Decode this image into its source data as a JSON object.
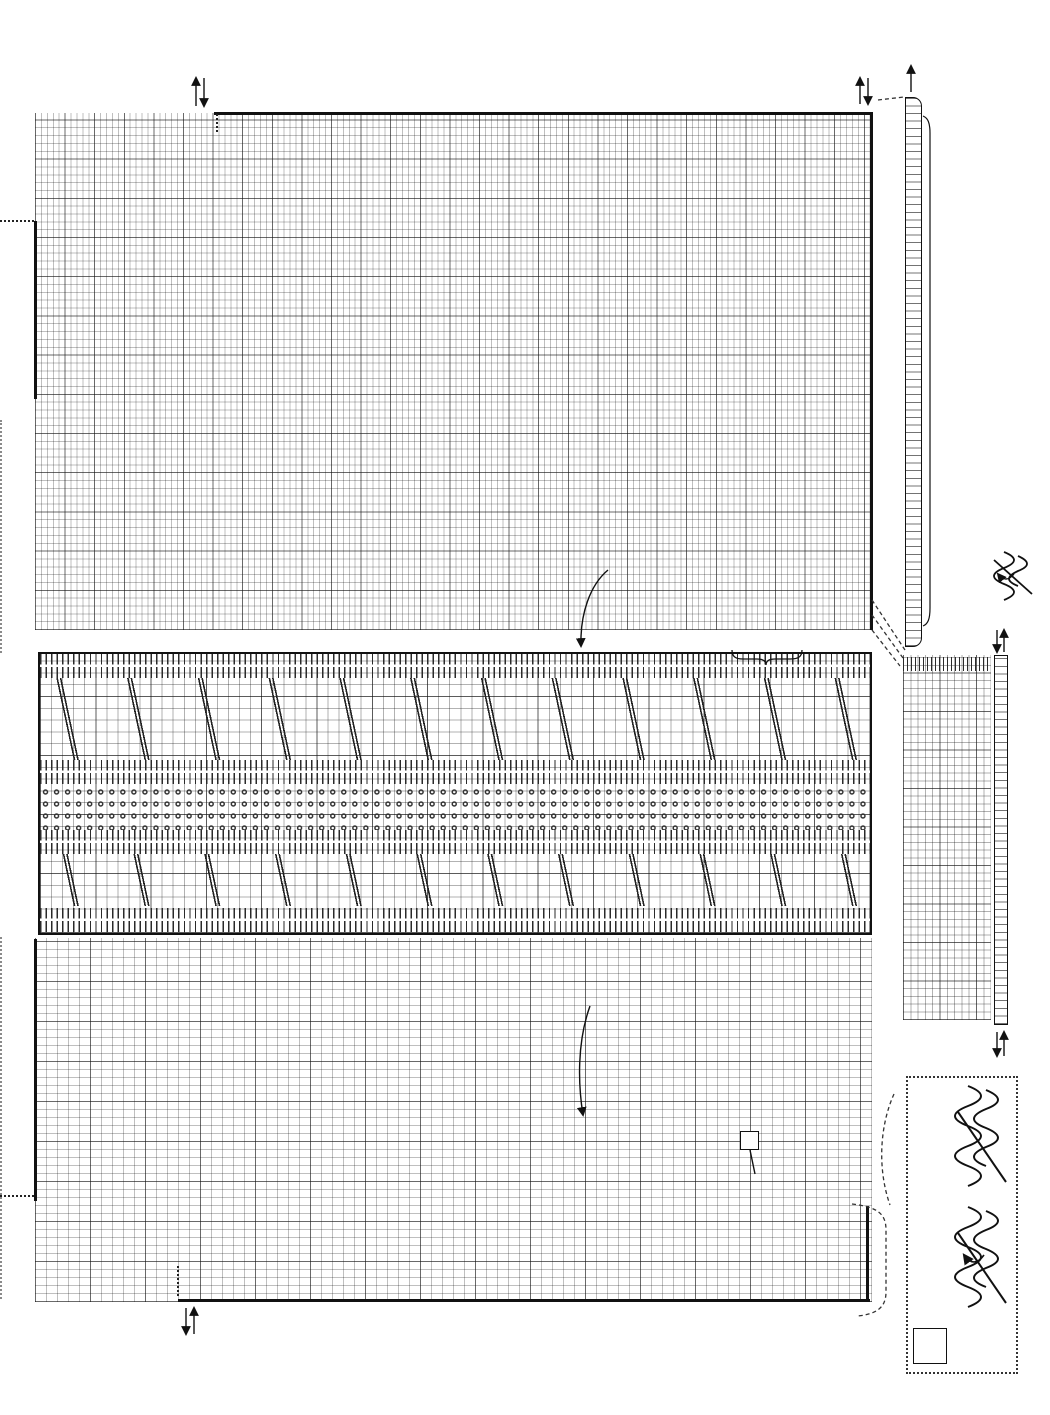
{
  "page": {
    "number": "71"
  },
  "symbols": {
    "lace_motif": "o+o",
    "decrease": "λ",
    "twisted_increase": "Ω",
    "heart_filled": "♥",
    "heart_open": "♡"
  },
  "chart_top": {
    "stitch_numbers": [
      {
        "t": "112",
        "x": 216,
        "y": 86
      },
      {
        "t": "110",
        "x": 228,
        "y": 86
      },
      {
        "t": "105",
        "x": 258,
        "y": 86
      },
      {
        "t": "100",
        "x": 287,
        "y": 86
      },
      {
        "t": "95",
        "x": 318,
        "y": 93
      },
      {
        "t": "90",
        "x": 347,
        "y": 93
      },
      {
        "t": "85",
        "x": 377,
        "y": 93
      },
      {
        "t": "80",
        "x": 406,
        "y": 93
      },
      {
        "t": "75",
        "x": 436,
        "y": 93
      },
      {
        "t": "70",
        "x": 465,
        "y": 93
      },
      {
        "t": "65",
        "x": 495,
        "y": 93
      },
      {
        "t": "60",
        "x": 524,
        "y": 93
      },
      {
        "t": "55",
        "x": 554,
        "y": 93
      },
      {
        "t": "50",
        "x": 583,
        "y": 93
      },
      {
        "t": "45",
        "x": 613,
        "y": 93
      },
      {
        "t": "40",
        "x": 642,
        "y": 93
      },
      {
        "t": "35",
        "x": 672,
        "y": 93
      },
      {
        "t": "30",
        "x": 701,
        "y": 93
      },
      {
        "t": "25",
        "x": 731,
        "y": 93
      },
      {
        "t": "20",
        "x": 760,
        "y": 93
      },
      {
        "t": "15",
        "x": 790,
        "y": 93
      },
      {
        "t": "10",
        "x": 819,
        "y": 93
      },
      {
        "t": "5",
        "x": 851,
        "y": 99
      }
    ],
    "shaping_numbers": [
      {
        "t": "30",
        "x": 42,
        "y": 194
      },
      {
        "t": "25",
        "x": 71,
        "y": 192
      },
      {
        "t": "20",
        "x": 100,
        "y": 188
      },
      {
        "t": "15",
        "x": 129,
        "y": 181
      },
      {
        "t": "10",
        "x": 158,
        "y": 169
      },
      {
        "t": "5",
        "x": 189,
        "y": 144
      }
    ],
    "row_numbers": [
      {
        "t": "1",
        "x": 876,
        "y": 112
      },
      {
        "t": "5",
        "x": 876,
        "y": 144
      },
      {
        "t": "10",
        "x": 876,
        "y": 181
      },
      {
        "t": "15",
        "x": 876,
        "y": 220
      },
      {
        "t": "20",
        "x": 876,
        "y": 260
      },
      {
        "t": "25",
        "x": 876,
        "y": 299
      },
      {
        "t": "30",
        "x": 876,
        "y": 338
      },
      {
        "t": "35",
        "x": 876,
        "y": 377
      },
      {
        "t": "40",
        "x": 876,
        "y": 417
      },
      {
        "t": "45",
        "x": 876,
        "y": 456
      },
      {
        "t": "50",
        "x": 876,
        "y": 495
      },
      {
        "t": "55",
        "x": 876,
        "y": 534
      },
      {
        "t": "60",
        "x": 876,
        "y": 573
      },
      {
        "t": "65",
        "x": 876,
        "y": 608
      }
    ],
    "direction_labels": [
      {
        "t": "1",
        "x": 206,
        "y": 70
      },
      {
        "t": "1",
        "x": 862,
        "y": 68
      }
    ],
    "motifs": [
      [
        80,
        42
      ],
      [
        222,
        42
      ],
      [
        364,
        42
      ],
      [
        506,
        42
      ],
      [
        648,
        42
      ],
      [
        790,
        42
      ],
      [
        151,
        89
      ],
      [
        293,
        89
      ],
      [
        435,
        89
      ],
      [
        577,
        89
      ],
      [
        719,
        89
      ],
      [
        80,
        136
      ],
      [
        222,
        136
      ],
      [
        364,
        136
      ],
      [
        506,
        136
      ],
      [
        648,
        136
      ],
      [
        790,
        136
      ],
      [
        151,
        183
      ],
      [
        293,
        183
      ],
      [
        435,
        183
      ],
      [
        577,
        183
      ],
      [
        719,
        183
      ],
      [
        80,
        230
      ],
      [
        222,
        230
      ],
      [
        364,
        230
      ],
      [
        506,
        230
      ],
      [
        648,
        230
      ],
      [
        790,
        230
      ],
      [
        151,
        277
      ],
      [
        293,
        277
      ],
      [
        435,
        277
      ],
      [
        577,
        277
      ],
      [
        719,
        277
      ],
      [
        80,
        324
      ],
      [
        222,
        324
      ],
      [
        364,
        324
      ],
      [
        506,
        324
      ],
      [
        648,
        324
      ],
      [
        790,
        324
      ],
      [
        151,
        371
      ],
      [
        293,
        371
      ],
      [
        435,
        371
      ],
      [
        577,
        371
      ],
      [
        719,
        371
      ],
      [
        80,
        418
      ],
      [
        222,
        418
      ],
      [
        364,
        418
      ],
      [
        506,
        418
      ],
      [
        648,
        418
      ],
      [
        790,
        418
      ],
      [
        151,
        465
      ],
      [
        293,
        465
      ],
      [
        435,
        465
      ],
      [
        577,
        465
      ],
      [
        719,
        465
      ]
    ],
    "edge_decreases": [
      [
        6,
        97
      ],
      [
        21,
        88
      ],
      [
        36,
        79
      ],
      [
        51,
        70
      ],
      [
        67,
        61
      ],
      [
        82,
        52
      ],
      [
        97,
        44
      ],
      [
        112,
        35
      ],
      [
        128,
        26
      ],
      [
        143,
        17
      ],
      [
        158,
        9
      ],
      [
        173,
        3
      ],
      [
        6,
        272
      ],
      [
        54,
        285
      ],
      [
        102,
        298
      ],
      [
        150,
        311
      ],
      [
        197,
        325
      ],
      [
        245,
        338
      ],
      [
        293,
        351
      ],
      [
        341,
        364
      ],
      [
        389,
        377
      ],
      [
        436,
        391
      ],
      [
        484,
        404
      ],
      [
        532,
        417
      ],
      [
        580,
        430
      ],
      [
        628,
        443
      ],
      [
        675,
        457
      ],
      [
        723,
        470
      ],
      [
        771,
        483
      ],
      [
        815,
        495
      ]
    ]
  },
  "pickup_strip": {
    "count_label": "18",
    "count_pos": [
      {
        "t": "18",
        "x": 899,
        "y": 46
      }
    ],
    "annotation": "別糸鎖から72目拾う"
  },
  "legend": {
    "line1": "＝18段めで♡の2目を編む時に",
    "line2": "♥の2目を裏側に折り返し一緒に編む",
    "front_label": "おもて"
  },
  "middle_chart": {
    "repeat_label": "12段1模様",
    "continue_label": "続けて編む"
  },
  "gusset": {
    "top_numbers": [
      {
        "t": "15",
        "x": 916,
        "y": 636
      },
      {
        "t": "10",
        "x": 944,
        "y": 636
      },
      {
        "t": "5",
        "x": 974,
        "y": 641
      }
    ],
    "row_numbers": [
      {
        "t": "1",
        "x": 1011,
        "y": 655
      },
      {
        "t": "5",
        "x": 1011,
        "y": 685
      },
      {
        "t": "10",
        "x": 1011,
        "y": 722
      },
      {
        "t": "15",
        "x": 1011,
        "y": 761
      },
      {
        "t": "20",
        "x": 1011,
        "y": 799
      },
      {
        "t": "25",
        "x": 1011,
        "y": 838
      },
      {
        "t": "30",
        "x": 1011,
        "y": 876
      },
      {
        "t": "35",
        "x": 1011,
        "y": 915
      },
      {
        "t": "40",
        "x": 1011,
        "y": 953
      },
      {
        "t": "45",
        "x": 1011,
        "y": 992
      },
      {
        "t": "48",
        "x": 1011,
        "y": 1013
      }
    ],
    "direction_labels": [
      {
        "t": "1",
        "x": 1008,
        "y": 636
      },
      {
        "t": "1",
        "x": 998,
        "y": 1060
      }
    ],
    "bottom_count": [
      {
        "t": "4",
        "x": 901,
        "y": 1026
      }
    ],
    "hearts": {
      "filled": "♥",
      "open": "♡"
    },
    "edge_decreases": [
      [
        2,
        48
      ],
      [
        8,
        93
      ],
      [
        15,
        138
      ],
      [
        22,
        183
      ],
      [
        29,
        228
      ],
      [
        36,
        273
      ],
      [
        43,
        318
      ],
      [
        46,
        345
      ]
    ]
  },
  "chart_bottom": {
    "row_numbers": [
      {
        "t": "1",
        "x": 873,
        "y": 1208
      },
      {
        "t": "2",
        "x": 873,
        "y": 1222
      },
      {
        "t": "5",
        "x": 873,
        "y": 1245
      },
      {
        "t": "10",
        "x": 871,
        "y": 1281
      },
      {
        "t": "12",
        "x": 871,
        "y": 1297
      }
    ],
    "direction_labels": [
      {
        "t": "1",
        "x": 202,
        "y": 1330
      },
      {
        "t": "112",
        "x": 212,
        "y": 1330
      }
    ],
    "twist_label": "ねじり増し目",
    "twist_symbol": "Ω",
    "first_row_label": "1段めの増し目",
    "motifs": [
      [
        62,
        95
      ],
      [
        202,
        95
      ],
      [
        342,
        95
      ],
      [
        482,
        95
      ],
      [
        622,
        95
      ],
      [
        762,
        95
      ],
      [
        132,
        138
      ],
      [
        272,
        138
      ],
      [
        412,
        138
      ],
      [
        552,
        138
      ],
      [
        692,
        138
      ],
      [
        62,
        181
      ],
      [
        202,
        181
      ],
      [
        342,
        181
      ],
      [
        482,
        181
      ],
      [
        622,
        181
      ],
      [
        762,
        181
      ],
      [
        132,
        224
      ],
      [
        272,
        224
      ],
      [
        412,
        224
      ],
      [
        552,
        224
      ],
      [
        692,
        224
      ],
      [
        62,
        267
      ],
      [
        202,
        267
      ],
      [
        342,
        267
      ],
      [
        482,
        267
      ],
      [
        622,
        267
      ],
      [
        762,
        267
      ],
      [
        132,
        310
      ],
      [
        272,
        310
      ],
      [
        412,
        310
      ],
      [
        552,
        310
      ],
      [
        692,
        310
      ]
    ],
    "omega_steps": [
      [
        31,
        11
      ],
      [
        104,
        34
      ],
      [
        178,
        58
      ],
      [
        251,
        81
      ],
      [
        324,
        105
      ],
      [
        397,
        128
      ],
      [
        471,
        152
      ],
      [
        544,
        175
      ],
      [
        617,
        199
      ],
      [
        690,
        222
      ],
      [
        764,
        246
      ]
    ],
    "edge_decreases": [
      [
        118,
        296
      ],
      [
        128,
        318
      ],
      [
        138,
        340
      ]
    ]
  },
  "technique_box": {
    "step_1": "1",
    "step_2": "2",
    "symbol": "Ω"
  },
  "layout_hints": {
    "guide_xs": [
      [
        96,
        0
      ],
      [
        167,
        0
      ],
      [
        238,
        0
      ],
      [
        308,
        0
      ],
      [
        379,
        0
      ],
      [
        450,
        0
      ],
      [
        520,
        0
      ],
      [
        591,
        0
      ],
      [
        662,
        0
      ],
      [
        732,
        0
      ],
      [
        803,
        0
      ]
    ]
  }
}
